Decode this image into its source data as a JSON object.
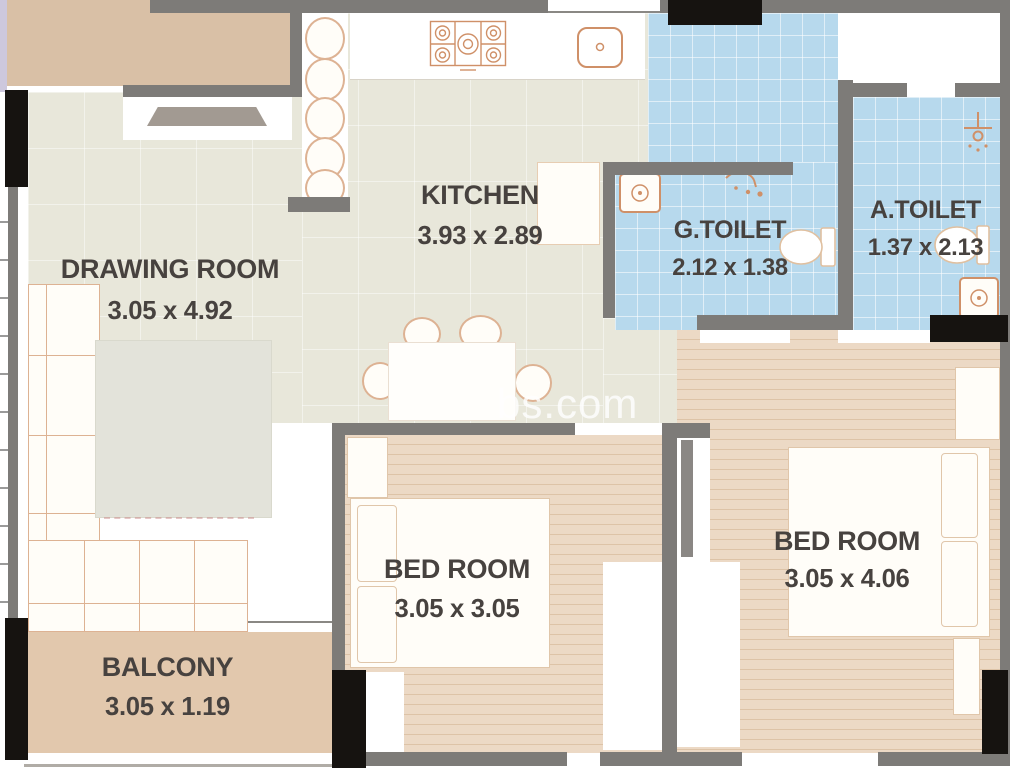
{
  "plan": {
    "watermark": "bs.com",
    "rooms": [
      {
        "id": "drawing-room",
        "name": "DRAWING ROOM",
        "dims": "3.05 x 4.92"
      },
      {
        "id": "kitchen",
        "name": "KITCHEN",
        "dims": "3.93 x 2.89"
      },
      {
        "id": "g-toilet",
        "name": "G.TOILET",
        "dims": "2.12 x 1.38"
      },
      {
        "id": "a-toilet",
        "name": "A.TOILET",
        "dims": "1.37 x 2.13"
      },
      {
        "id": "bedroom-1",
        "name": "BED ROOM",
        "dims": "3.05 x 3.05"
      },
      {
        "id": "bedroom-2",
        "name": "BED ROOM",
        "dims": "3.05 x 4.06"
      },
      {
        "id": "balcony",
        "name": "BALCONY",
        "dims": "3.05 x 1.19"
      }
    ],
    "colors": {
      "wall": "#7d7b78",
      "column": "#161310",
      "floor_living": "#e8e7da",
      "floor_tile": "#b7d9ed",
      "floor_wood": "#ecd9c5",
      "floor_balcony": "#e2c8ad",
      "exterior": "#d9c0a6",
      "fixture": "#cf9068",
      "label": "#47423f",
      "watermark": "#ffffff"
    }
  }
}
